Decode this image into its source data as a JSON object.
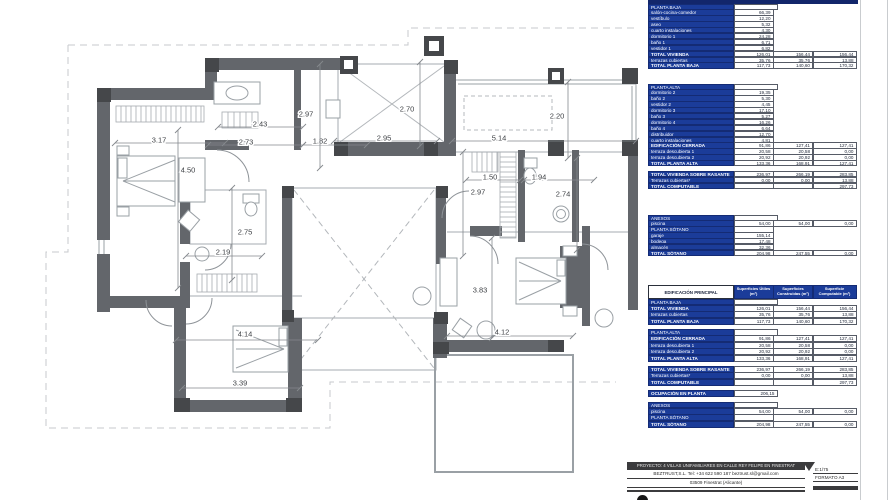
{
  "colors": {
    "table_blue": "#1b3c99",
    "wall_gray": "#63666b",
    "column_gray": "#45474a",
    "accent_dark": "#3b3b3d"
  },
  "plan": {
    "dimensions": [
      {
        "v": "3.17",
        "o": "h",
        "x1": 115,
        "y1": 143,
        "x2": 225,
        "y2": 143,
        "lx": 159,
        "ly": 140
      },
      {
        "v": "2.43",
        "o": "h",
        "x1": 218,
        "y1": 127,
        "x2": 303,
        "y2": 127,
        "lx": 260,
        "ly": 124
      },
      {
        "v": "2.73",
        "o": "h",
        "x1": 208,
        "y1": 145,
        "x2": 303,
        "y2": 145,
        "lx": 246,
        "ly": 142
      },
      {
        "v": "1.82",
        "o": "h",
        "x1": 303,
        "y1": 145,
        "x2": 367,
        "y2": 145,
        "lx": 320,
        "ly": 141
      },
      {
        "v": "2.97",
        "o": "v",
        "x1": 320,
        "y1": 64,
        "x2": 320,
        "y2": 168,
        "lx": 306,
        "ly": 114
      },
      {
        "v": "4.50",
        "o": "v",
        "x1": 178,
        "y1": 130,
        "x2": 178,
        "y2": 288,
        "lx": 188,
        "ly": 170
      },
      {
        "v": "2.95",
        "o": "h",
        "x1": 334,
        "y1": 141,
        "x2": 437,
        "y2": 141,
        "lx": 384,
        "ly": 138
      },
      {
        "v": "2.70",
        "o": "v",
        "x1": 420,
        "y1": 62,
        "x2": 420,
        "y2": 146,
        "lx": 407,
        "ly": 109
      },
      {
        "v": "5.14",
        "o": "h",
        "x1": 452,
        "y1": 141,
        "x2": 636,
        "y2": 141,
        "lx": 499,
        "ly": 138
      },
      {
        "v": "2.20",
        "o": "v",
        "x1": 568,
        "y1": 82,
        "x2": 568,
        "y2": 158,
        "lx": 557,
        "ly": 116
      },
      {
        "v": "1.50",
        "o": "h",
        "x1": 466,
        "y1": 180,
        "x2": 520,
        "y2": 180,
        "lx": 490,
        "ly": 177
      },
      {
        "v": "1.94",
        "o": "h",
        "x1": 524,
        "y1": 180,
        "x2": 594,
        "y2": 180,
        "lx": 539,
        "ly": 177
      },
      {
        "v": "2.97",
        "o": "v",
        "x1": 463,
        "y1": 152,
        "x2": 463,
        "y2": 256,
        "lx": 478,
        "ly": 192
      },
      {
        "v": "2.74",
        "o": "v",
        "x1": 577,
        "y1": 158,
        "x2": 577,
        "y2": 250,
        "lx": 563,
        "ly": 194
      },
      {
        "v": "2.75",
        "o": "v",
        "x1": 232,
        "y1": 188,
        "x2": 232,
        "y2": 280,
        "lx": 245,
        "ly": 232
      },
      {
        "v": "2.19",
        "o": "h",
        "x1": 186,
        "y1": 256,
        "x2": 262,
        "y2": 256,
        "lx": 223,
        "ly": 252
      },
      {
        "v": "4.14",
        "o": "h",
        "x1": 176,
        "y1": 340,
        "x2": 318,
        "y2": 340,
        "lx": 245,
        "ly": 334
      },
      {
        "v": "3.39",
        "o": "h",
        "x1": 182,
        "y1": 388,
        "x2": 300,
        "y2": 388,
        "lx": 240,
        "ly": 383
      },
      {
        "v": "3.83",
        "o": "v",
        "x1": 492,
        "y1": 238,
        "x2": 492,
        "y2": 338,
        "lx": 480,
        "ly": 290
      },
      {
        "v": "4.12",
        "o": "h",
        "x1": 447,
        "y1": 336,
        "x2": 573,
        "y2": 336,
        "lx": 502,
        "ly": 332
      }
    ]
  },
  "tables": {
    "upper_baja": {
      "rows": [
        {
          "t": "sec",
          "l": "PLANTA BAJA"
        },
        {
          "t": "r1",
          "l": "salón-cocina-comedor",
          "v": [
            "66,39"
          ]
        },
        {
          "t": "r1",
          "l": "vestíbulo",
          "v": [
            "12,20"
          ]
        },
        {
          "t": "r1",
          "l": "aseo",
          "v": [
            "5,32"
          ]
        },
        {
          "t": "r1",
          "l": "cuarto instalaciones",
          "v": [
            "4,30"
          ]
        },
        {
          "t": "r1",
          "l": "dormitorio 1",
          "v": [
            "24,28"
          ]
        },
        {
          "t": "r1",
          "l": "baño 1",
          "v": [
            "6,71"
          ]
        },
        {
          "t": "r1",
          "l": "vestidor 1",
          "v": [
            "6,82"
          ]
        },
        {
          "t": "tot",
          "l": "TOTAL VIVIENDA",
          "v": [
            "126,01",
            "156,44",
            "156,44"
          ]
        },
        {
          "t": "r3",
          "l": "terrazas cubiertas",
          "v": [
            "35,76",
            "35,76",
            "13,88"
          ]
        },
        {
          "t": "tot",
          "l": "TOTAL PLANTA BAJA",
          "v": [
            "117,73",
            "140,60",
            "170,32"
          ]
        }
      ]
    },
    "upper_alta": {
      "rows": [
        {
          "t": "sec",
          "l": "PLANTA ALTA"
        },
        {
          "t": "r1",
          "l": "dormitorio 2",
          "v": [
            "19,35"
          ]
        },
        {
          "t": "r1",
          "l": "baño 2",
          "v": [
            "5,30"
          ]
        },
        {
          "t": "r1",
          "l": "vestidor 2",
          "v": [
            "4,45"
          ]
        },
        {
          "t": "r1",
          "l": "dormitorio 3",
          "v": [
            "17,10"
          ]
        },
        {
          "t": "r1",
          "l": "baño 3",
          "v": [
            "5,27"
          ]
        },
        {
          "t": "r1",
          "l": "dormitorio 4",
          "v": [
            "16,26"
          ]
        },
        {
          "t": "r1",
          "l": "baño 4",
          "v": [
            "6,64"
          ]
        },
        {
          "t": "r1",
          "l": "distribuidor",
          "v": [
            "12,70"
          ]
        },
        {
          "t": "r1",
          "l": "cuarto instalaciones",
          "v": [
            "4,81"
          ]
        },
        {
          "t": "tot",
          "l": "EDIFICACIÓN CERRADA",
          "v": [
            "91,86",
            "127,41",
            "127,41"
          ]
        },
        {
          "t": "r3",
          "l": "terraza descubierta 1",
          "v": [
            "20,58",
            "20,58",
            "0,00"
          ]
        },
        {
          "t": "r3",
          "l": "terraza descubierta 2",
          "v": [
            "20,92",
            "20,92",
            "0,00"
          ]
        },
        {
          "t": "tot",
          "l": "TOTAL PLANTA ALTA",
          "v": [
            "133,36",
            "168,91",
            "127,41"
          ]
        },
        {
          "t": "gap"
        },
        {
          "t": "tot",
          "l": "TOTAL VIVIENDA SOBRE RASANTE",
          "v": [
            "236,97",
            "266,19",
            "283,85"
          ]
        },
        {
          "t": "r3",
          "l": "Terrazas cubiertas*",
          "v": [
            "0,00",
            "0,00",
            "13,88"
          ]
        },
        {
          "t": "tot3",
          "l": "TOTAL COMPUTABLE",
          "v": [
            "297,73"
          ]
        }
      ]
    },
    "upper_anexos": {
      "rows": [
        {
          "t": "sec",
          "l": "ANEXOS"
        },
        {
          "t": "r3",
          "l": "piscina",
          "v": [
            "54,00",
            "54,00",
            "0,00"
          ]
        },
        {
          "t": "sec1",
          "l": "PLANTA SÓTANO"
        },
        {
          "t": "r1",
          "l": "garaje",
          "v": [
            "155,14"
          ]
        },
        {
          "t": "r1",
          "l": "bodega",
          "v": [
            "17,48"
          ]
        },
        {
          "t": "r1",
          "l": "almacén",
          "v": [
            "32,36"
          ]
        },
        {
          "t": "tot",
          "l": "TOTAL SÓTANO",
          "v": [
            "204,98",
            "247,55",
            "0,00"
          ]
        }
      ]
    },
    "summary": {
      "header": {
        "title": "EDIFICACIÓN PRINCIPAL",
        "c1": "Superficies Útiles (m²)",
        "c2": "Superficies Construidas (m²)",
        "c3": "Superficie Computable (m²)"
      },
      "rows": [
        {
          "t": "sec",
          "l": "PLANTA BAJA"
        },
        {
          "t": "tot",
          "l": "TOTAL VIVIENDA",
          "v": [
            "126,01",
            "156,44",
            "156,44"
          ]
        },
        {
          "t": "r3",
          "l": "terrazas cubiertas",
          "v": [
            "35,76",
            "35,76",
            "13,88"
          ]
        },
        {
          "t": "tot",
          "l": "TOTAL PLANTA BAJA",
          "v": [
            "117,73",
            "140,60",
            "170,32"
          ]
        },
        {
          "t": "gap"
        },
        {
          "t": "sec",
          "l": "PLANTA ALTA"
        },
        {
          "t": "tot",
          "l": "EDIFICACIÓN CERRADA",
          "v": [
            "91,86",
            "127,41",
            "127,41"
          ]
        },
        {
          "t": "r3",
          "l": "terraza descubierta 1",
          "v": [
            "20,58",
            "20,58",
            "0,00"
          ]
        },
        {
          "t": "r3",
          "l": "terraza descubierta 2",
          "v": [
            "20,92",
            "20,92",
            "0,00"
          ]
        },
        {
          "t": "tot",
          "l": "TOTAL PLANTA ALTA",
          "v": [
            "133,36",
            "168,91",
            "127,41"
          ]
        },
        {
          "t": "gap"
        },
        {
          "t": "tot",
          "l": "TOTAL VIVIENDA SOBRE RASANTE",
          "v": [
            "236,97",
            "266,19",
            "283,85"
          ]
        },
        {
          "t": "r3",
          "l": "Terrazas cubiertas*",
          "v": [
            "0,00",
            "0,00",
            "13,88"
          ]
        },
        {
          "t": "tot3",
          "l": "TOTAL COMPUTABLE",
          "v": [
            "297,73"
          ]
        },
        {
          "t": "gap"
        },
        {
          "t": "occ",
          "l": "OCUPACIÓN EN PLANTA",
          "v": [
            "206,15"
          ]
        },
        {
          "t": "gap"
        },
        {
          "t": "sec",
          "l": "ANEXOS"
        },
        {
          "t": "r3",
          "l": "piscina",
          "v": [
            "54,00",
            "54,00",
            "0,00"
          ]
        },
        {
          "t": "sec1",
          "l": "PLANTA SÓTANO"
        },
        {
          "t": "tot",
          "l": "TOTAL SÓTANO",
          "v": [
            "204,98",
            "247,55",
            "0,00"
          ]
        }
      ]
    }
  },
  "titleblock": {
    "project": "PROYECTO: 4 VILLAS UNIFAMILIARES EN CALLE REY FELIPE EN FINESTRAT",
    "company": "BEZTRUST,S.L.   Tel:  +34 622 590 187     beztrust.sl@gmail.com",
    "address": "03509 Finestrat (Alicante)",
    "scale": "E:1/75",
    "format": "FORMATO A3"
  }
}
